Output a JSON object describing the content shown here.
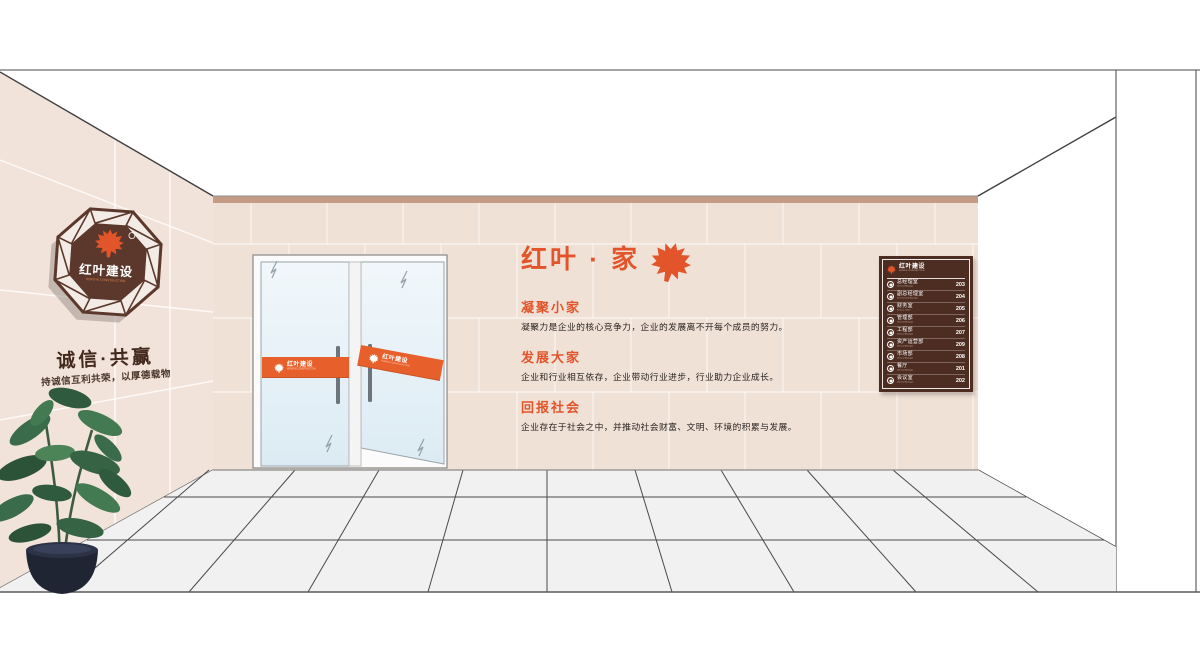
{
  "left_wall": {
    "logo_sign": {
      "brand_cn": "红叶建设",
      "brand_en": "HONGYE CONSTRUCTION",
      "registered_mark": "®",
      "leaf_icon": "maple-leaf"
    },
    "slogan_main": "诚信·共赢",
    "slogan_sub": "持诚信互利共荣，以厚德载物"
  },
  "doors": {
    "band_brand_cn": "红叶建设",
    "band_brand_en": "HONGYE CONSTRUCTION"
  },
  "feature_wall": {
    "title": "红叶 · 家",
    "title_leaf_icon": "maple-leaf",
    "sections": [
      {
        "heading": "凝聚小家",
        "body": "凝聚力是企业的核心竞争力，企业的发展离不开每个成员的努力。"
      },
      {
        "heading": "发展大家",
        "body": "企业和行业相互依存，企业带动行业进步，行业助力企业成长。"
      },
      {
        "heading": "回报社会",
        "body": "企业存在于社会之中，并推动社会财富、文明、环境的积累与发展。"
      }
    ]
  },
  "directory_board": {
    "brand_cn": "红叶建设",
    "brand_en": "HONGYE CONSTRUCTION",
    "rows": [
      {
        "label_cn": "总经理室",
        "label_en": "General Manager",
        "room": "203"
      },
      {
        "label_cn": "副总经理室",
        "label_en": "Vice General Manager",
        "room": "204"
      },
      {
        "label_cn": "财务室",
        "label_en": "Finance Office",
        "room": "205"
      },
      {
        "label_cn": "管理部",
        "label_en": "General Manager",
        "room": "206"
      },
      {
        "label_cn": "工程部",
        "label_en": "General Manager",
        "room": "207"
      },
      {
        "label_cn": "资产运营部",
        "label_en": "General Manager",
        "room": "209"
      },
      {
        "label_cn": "市场部",
        "label_en": "General Manager",
        "room": "208"
      },
      {
        "label_cn": "餐厅",
        "label_en": "General Manager",
        "room": "201"
      },
      {
        "label_cn": "会议室",
        "label_en": "General Manager",
        "room": "202"
      }
    ]
  },
  "colors": {
    "accent_orange": "#e2542a",
    "band_orange": "#e7602c",
    "brand_brown": "#5b382b",
    "board_brown": "#4d2d21",
    "wall_beige": "#f0e1d7",
    "wall_top_strip": "#c49b85",
    "floor_gray": "#f1f1f2",
    "scene_line": "#4a4a4a",
    "text_dark": "#2a2421",
    "glass_blue": "#e7f1f8",
    "pot_navy": "#1f2533",
    "leaf_green": "#3a6b4a"
  }
}
